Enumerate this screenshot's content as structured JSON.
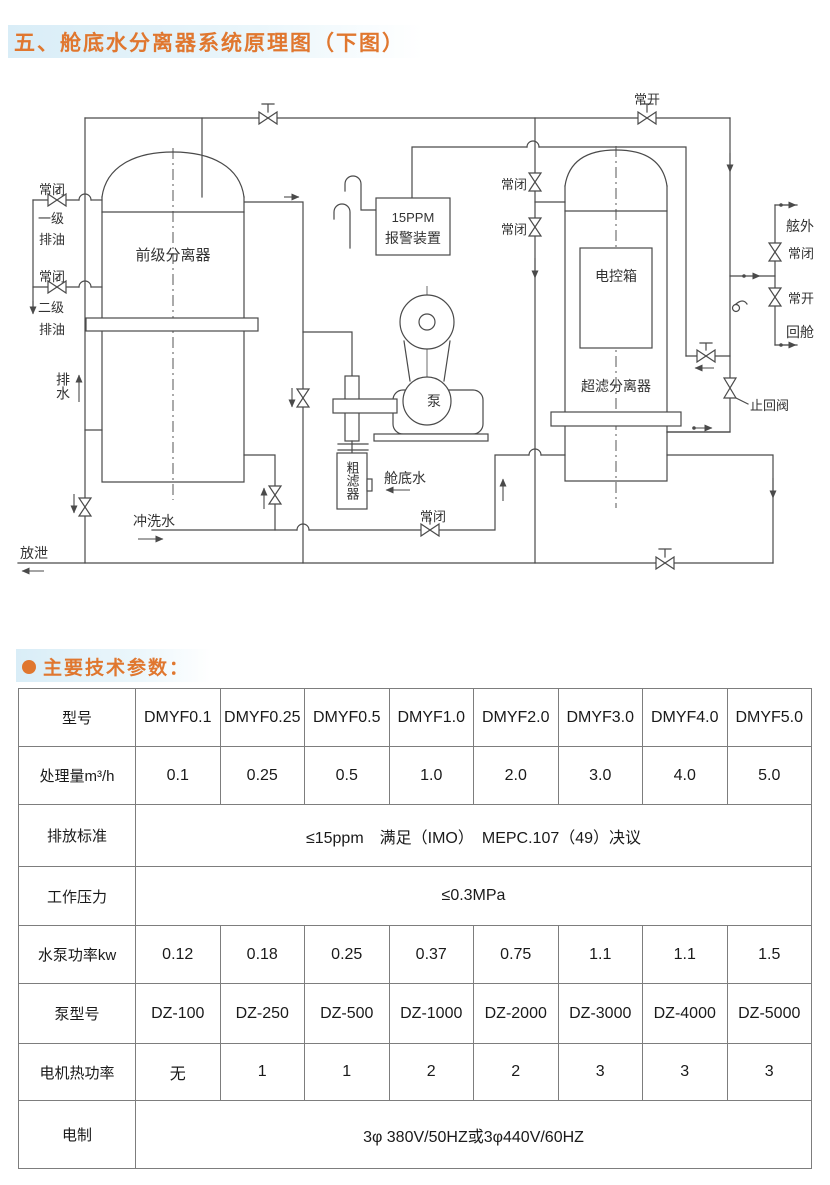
{
  "page": {
    "title": "五、舱底水分离器系统原理图（下图）",
    "section_title": "主要技术参数："
  },
  "colors": {
    "accent_orange": "#e0772f",
    "band_blue": "#d9edf7",
    "line_gray": "#4a4a4a",
    "table_border": "#7d7d7d"
  },
  "diagram": {
    "labels": {
      "normally_open": "常开",
      "normally_closed": "常闭",
      "stage1": "一级",
      "stage2": "二级",
      "oil_discharge": "排油",
      "drain_water": "排水",
      "blow_off": "放泄",
      "flush_water": "冲洗水",
      "primary_separator": "前级分离器",
      "ppm_line1": "15PPM",
      "ppm_line2": "报警装置",
      "pump": "泵",
      "coarse_filter": "粗滤器",
      "bilge_water": "舱底水",
      "control_box": "电控箱",
      "uf_separator": "超滤分离器",
      "check_valve": "止回阀",
      "overboard": "舷外",
      "return_to_tank": "回舱"
    }
  },
  "table": {
    "rows": [
      {
        "label": "型号",
        "cells": [
          "DMYF0.1",
          "DMYF0.25",
          "DMYF0.5",
          "DMYF1.0",
          "DMYF2.0",
          "DMYF3.0",
          "DMYF4.0",
          "DMYF5.0"
        ]
      },
      {
        "label": "处理量m³/h",
        "cells": [
          "0.1",
          "0.25",
          "0.5",
          "1.0",
          "2.0",
          "3.0",
          "4.0",
          "5.0"
        ]
      },
      {
        "label": "排放标准",
        "span": "≤15ppm　满足（IMO）　MEPC.107（49）决议"
      },
      {
        "label": "工作压力",
        "span": "≤0.3MPa"
      },
      {
        "label": "水泵功率kw",
        "cells": [
          "0.12",
          "0.18",
          "0.25",
          "0.37",
          "0.75",
          "1.1",
          "1.1",
          "1.5"
        ]
      },
      {
        "label": "泵型号",
        "cells": [
          "DZ-100",
          "DZ-250",
          "DZ-500",
          "DZ-1000",
          "DZ-2000",
          "DZ-3000",
          "DZ-4000",
          "DZ-5000"
        ]
      },
      {
        "label": "电机热功率",
        "cells": [
          "无",
          "1",
          "1",
          "2",
          "2",
          "3",
          "3",
          "3"
        ]
      },
      {
        "label": "电制",
        "span": "3φ 380V/50HZ或3φ440V/60HZ"
      }
    ]
  }
}
